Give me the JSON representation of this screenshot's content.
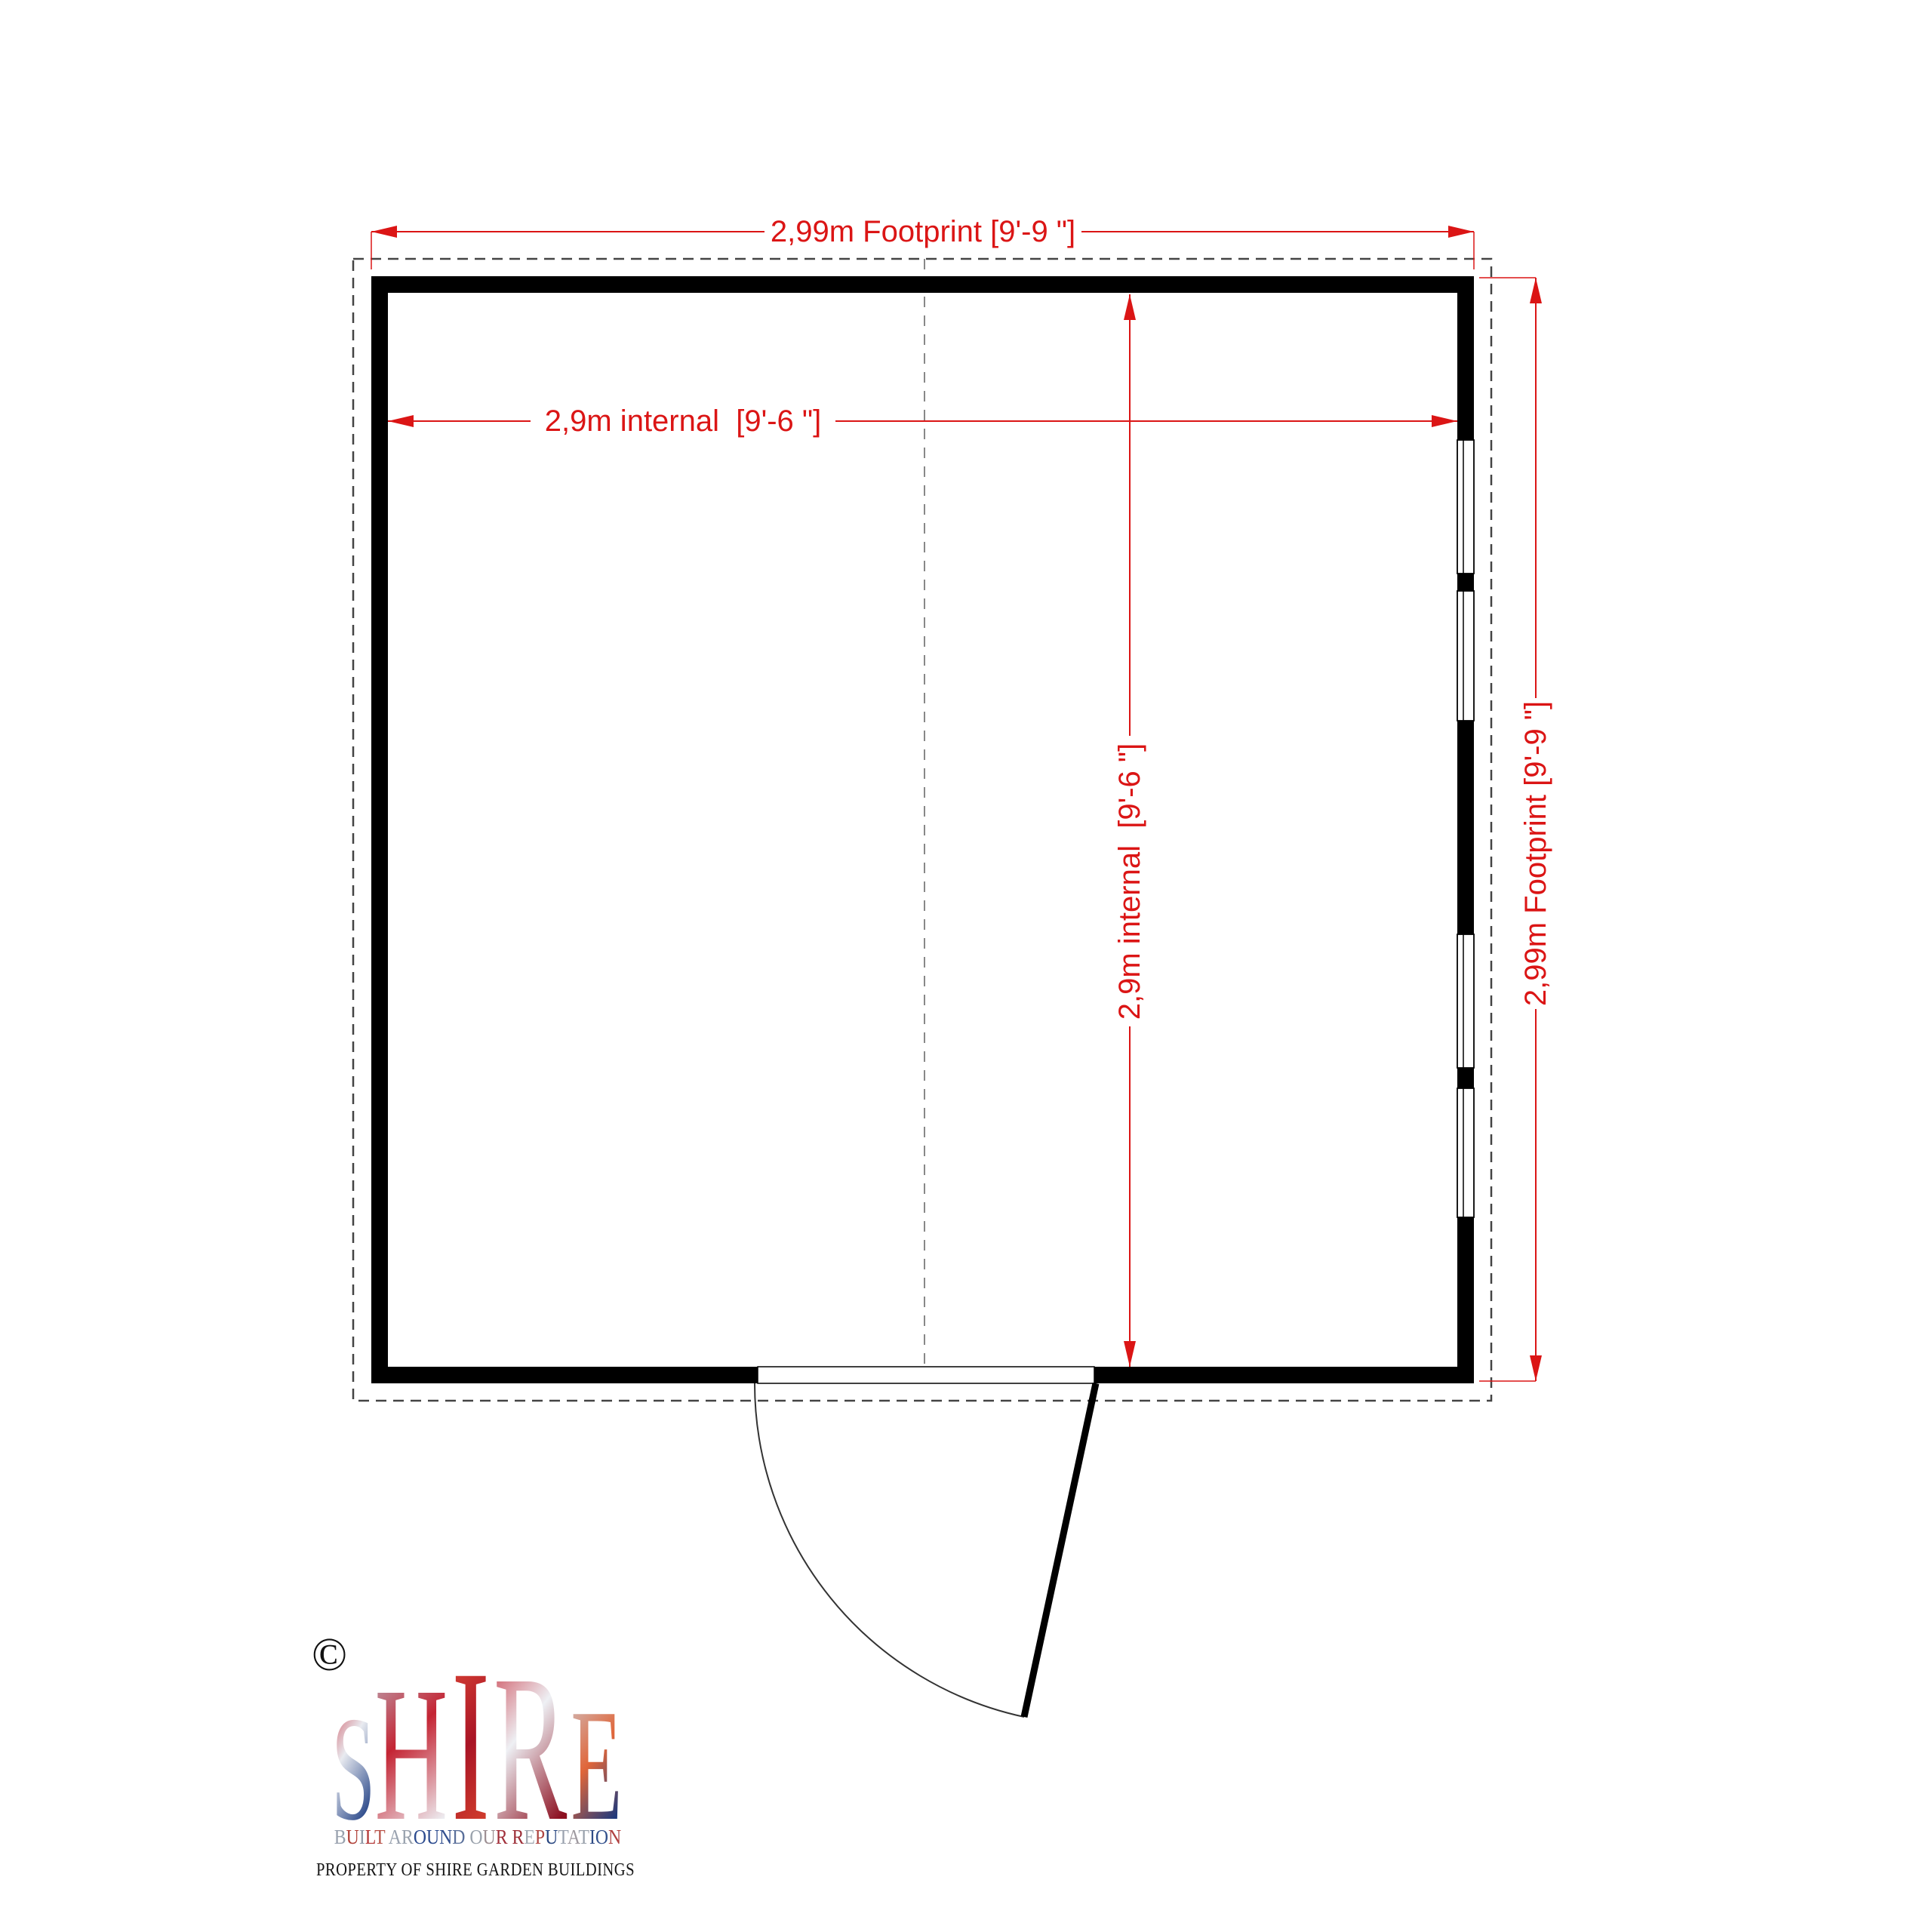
{
  "drawing": {
    "dimensions": {
      "top_footprint": "2,99m Footprint [9'-9 \"]",
      "internal_width": "2,9m internal  [9'-6 \"]",
      "internal_depth": "2,9m internal  [9'-6 \"]",
      "right_footprint": "2,99m Footprint [9'-9 \"]"
    },
    "colors": {
      "dimension_red": "#db1515",
      "wall_black": "#000000",
      "footprint_dash_grey": "#444444",
      "centerline_grey": "#888888"
    }
  },
  "logo": {
    "copyright_symbol": "©",
    "brand_word": "SHIRE",
    "brand_letters": [
      "S",
      "H",
      "I",
      "R",
      "E"
    ],
    "brand_gradients": [
      [
        "#c42433",
        "#e9ebf0",
        "#16377f"
      ],
      [
        "#b9c1cd",
        "#c42433",
        "#eef0f4"
      ],
      [
        "#e8523a",
        "#a91425",
        "#d8452e"
      ],
      [
        "#c42433",
        "#eef0f4",
        "#8c1020"
      ],
      [
        "#ccd1da",
        "#e0663a",
        "#16377f"
      ]
    ],
    "tagline": "BUILT AROUND OUR REPUTATION",
    "tagline_colors": [
      "#97a0ad",
      "#b04038",
      "#8e98a6",
      "#b23434",
      "#b75046",
      "",
      "#9aa3b0",
      "#98a1ad",
      "#2b4a8e",
      "#2b4a8e",
      "#33508f",
      "#5a6f9a",
      "",
      "#9aa2ac",
      "#9d8f93",
      "#a12f3a",
      "",
      "#9c2f38",
      "#a0a7b0",
      "#ae4440",
      "#27457f",
      "#9aa2ae",
      "#9f9aa0",
      "#99a1ab",
      "#2f4c86",
      "#32508c",
      "#b04040"
    ],
    "property_line": "PROPERTY OF SHIRE GARDEN BUILDINGS"
  }
}
